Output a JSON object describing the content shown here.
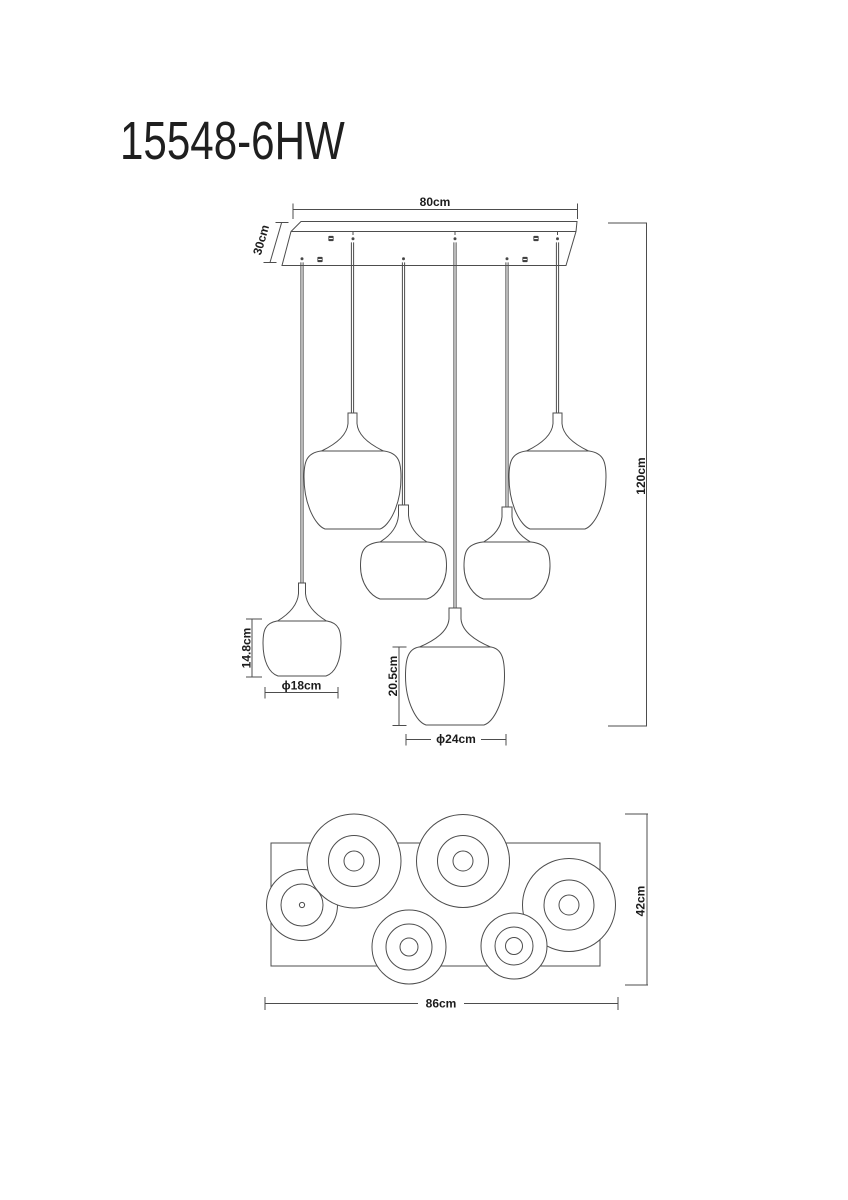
{
  "title": "15548-6HW",
  "front_view": {
    "shade_count": 6,
    "dims": {
      "canopy_width": "80cm",
      "canopy_depth": "30cm",
      "overall_height": "120cm",
      "small_shade_height": "14.8cm",
      "small_shade_diameter": "ϕ18cm",
      "large_shade_height": "20.5cm",
      "large_shade_diameter": "ϕ24cm"
    }
  },
  "plan_view": {
    "dims": {
      "overall_width": "86cm",
      "overall_depth": "42cm"
    }
  },
  "colors": {
    "line": "#4d4d4d",
    "text": "#1c1c1c",
    "background": "#ffffff"
  }
}
